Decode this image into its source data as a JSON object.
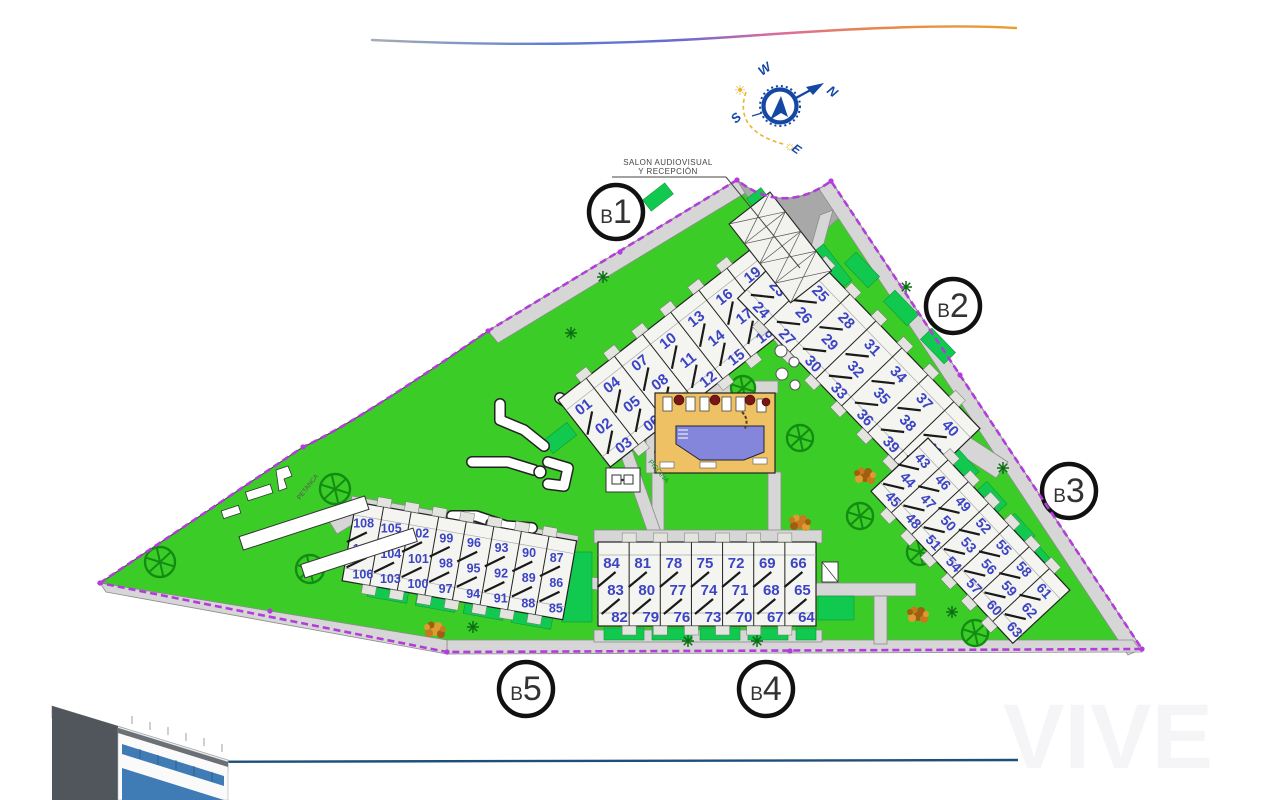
{
  "labels": {
    "reception_line1": "SALON AUDIOVISUAL",
    "reception_line2": "Y RECEPCIÓN",
    "petanca": "PETANCA",
    "pool_room": "PISCINA",
    "watermark": "VIVE"
  },
  "compass": {
    "north": "N",
    "south": "S",
    "east": "E",
    "west": "W"
  },
  "icons": {
    "sun_filled": "☀",
    "sun_outline": "☼"
  },
  "buildings": [
    {
      "label": "B1",
      "units": [
        [
          "01",
          "02",
          "03"
        ],
        [
          "04",
          "05",
          "06"
        ],
        [
          "07",
          "08",
          "09"
        ],
        [
          "10",
          "11",
          "12"
        ],
        [
          "13",
          "14",
          "15"
        ],
        [
          "16",
          "17",
          "18"
        ],
        [
          "19",
          "20",
          "21"
        ]
      ]
    },
    {
      "label": "B2",
      "units": [
        [
          "22",
          "23",
          "24"
        ],
        [
          "25",
          "26",
          "27"
        ],
        [
          "28",
          "29",
          "30"
        ],
        [
          "31",
          "32",
          "33"
        ],
        [
          "34",
          "35",
          "36"
        ],
        [
          "37",
          "38",
          "39"
        ],
        [
          "40",
          "41",
          "42"
        ]
      ]
    },
    {
      "label": "B3",
      "units": [
        [
          "43",
          "44",
          "45"
        ],
        [
          "46",
          "47",
          "48"
        ],
        [
          "49",
          "50",
          "51"
        ],
        [
          "52",
          "53",
          "54"
        ],
        [
          "55",
          "56",
          "57"
        ],
        [
          "58",
          "59",
          "60"
        ],
        [
          "61",
          "62",
          "63"
        ]
      ]
    },
    {
      "label": "B4",
      "units": [
        [
          "84",
          "83",
          "82"
        ],
        [
          "81",
          "80",
          "79"
        ],
        [
          "78",
          "77",
          "76"
        ],
        [
          "75",
          "74",
          "73"
        ],
        [
          "72",
          "71",
          "70"
        ],
        [
          "69",
          "68",
          "67"
        ],
        [
          "66",
          "65",
          "64"
        ]
      ]
    },
    {
      "label": "B5",
      "units": [
        [
          "108",
          "107",
          "106"
        ],
        [
          "105",
          "104",
          "103"
        ],
        [
          "102",
          "101",
          "100"
        ],
        [
          "99",
          "98",
          "97"
        ],
        [
          "96",
          "95",
          "94"
        ],
        [
          "93",
          "92",
          "91"
        ],
        [
          "90",
          "89",
          "88"
        ],
        [
          "87",
          "86",
          "85"
        ]
      ]
    }
  ],
  "colors": {
    "lawn": "#3ccc28",
    "hedge": "#12c94f",
    "path": "#d6d6d6",
    "boundary": "#b43cdc",
    "unit_number": "#3b44c4",
    "pool_water": "#8486dc",
    "pool_deck": "#eec264",
    "tree": "#128c12",
    "umbrella": "#7a1616",
    "compass_blue": "#1547a5",
    "sun": "#e8b428"
  }
}
